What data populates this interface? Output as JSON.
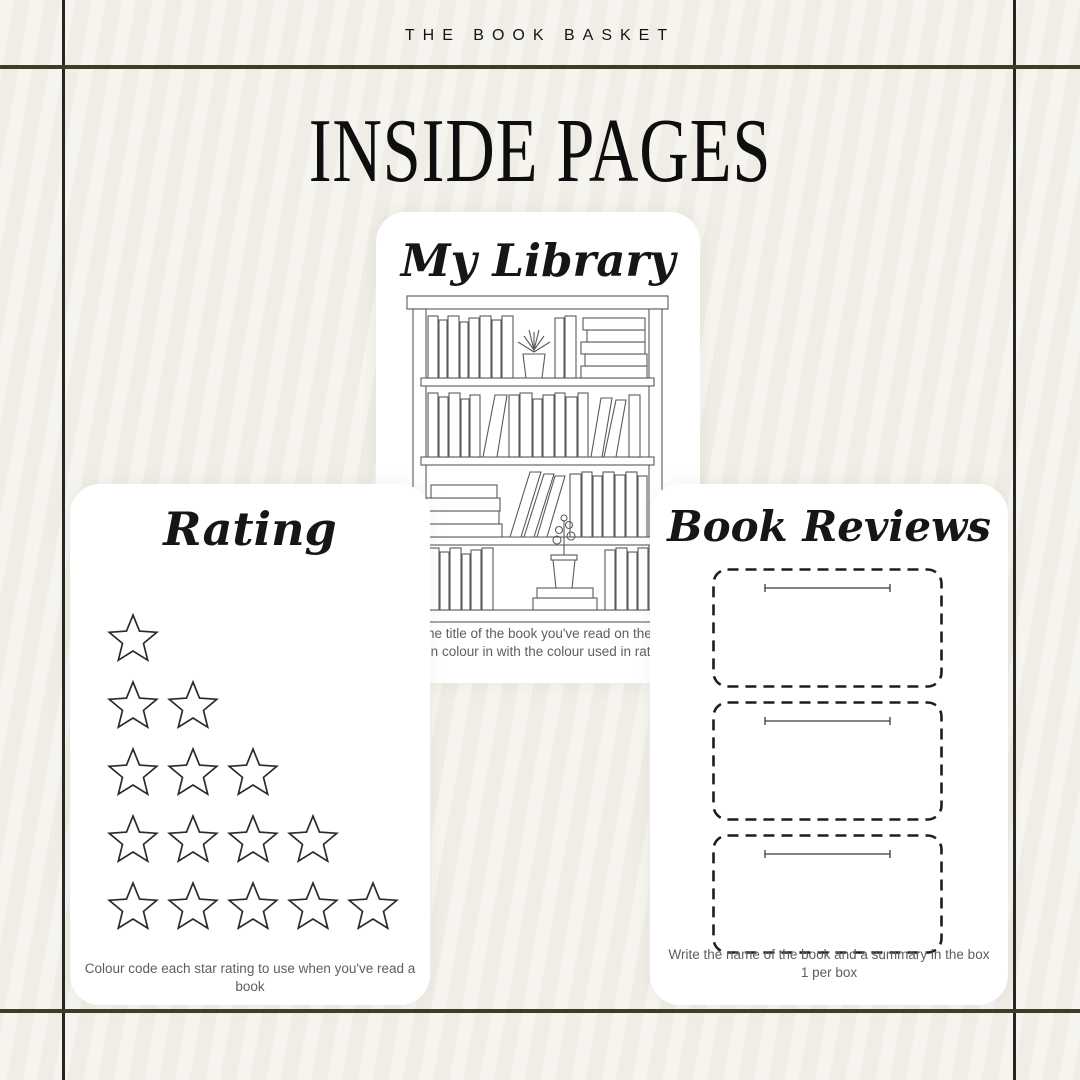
{
  "brand": {
    "name": "THE BOOK BASKET"
  },
  "page": {
    "title": "INSIDE PAGES"
  },
  "cards": {
    "library": {
      "title": "My Library",
      "caption_line1": "Write the title of the book you've read on the spine",
      "caption_line2": "Then colour in with the colour used in rating",
      "icon": "bookshelf-illustration"
    },
    "rating": {
      "title": "Rating",
      "caption": "Colour code each star rating to use when you've read a book",
      "icon": "star-icon",
      "star_rows": [
        1,
        2,
        3,
        4,
        5
      ]
    },
    "reviews": {
      "title": "Book Reviews",
      "caption_line1": "Write the name of the book and a summary in the box",
      "caption_line2": "1 per box",
      "box_count": 3
    }
  },
  "colors": {
    "background": "#f3f1ea",
    "card": "#ffffff",
    "frame_vertical": "#262624",
    "frame_horizontal": "#3f3b24",
    "ink": "#141414",
    "caption_gray": "#5e5e5e",
    "lineart_gray": "#5a5a5a"
  }
}
